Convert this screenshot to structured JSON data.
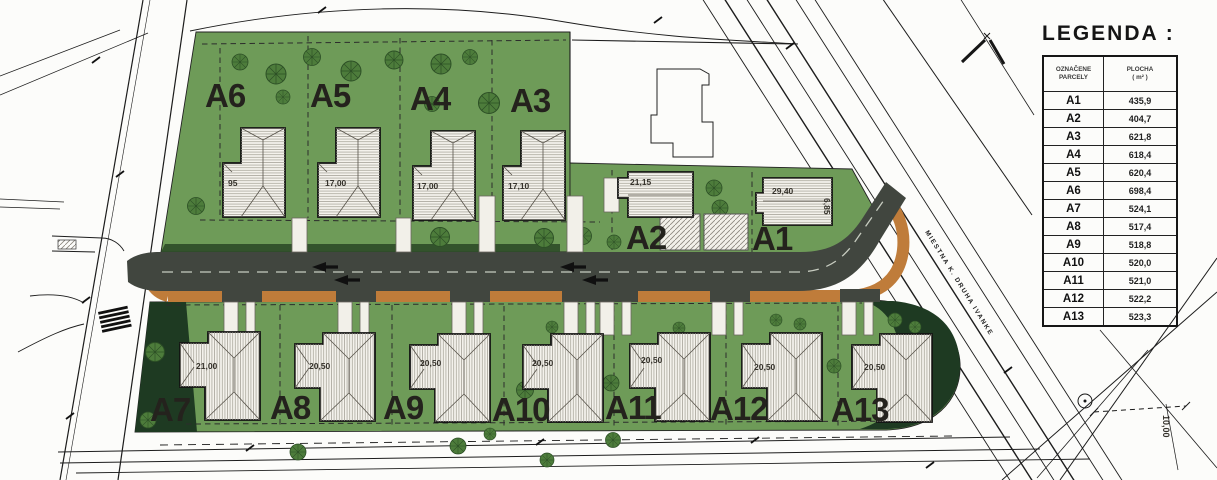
{
  "legend": {
    "title": "LEGENDA :",
    "header": {
      "parcel_line1": "OZNAČENE",
      "parcel_line2": "PARCELY",
      "area_line1": "PLOCHA",
      "area_line2": "( m² )"
    },
    "rows": [
      {
        "id": "A1",
        "area": "435,9"
      },
      {
        "id": "A2",
        "area": "404,7"
      },
      {
        "id": "A3",
        "area": "621,8"
      },
      {
        "id": "A4",
        "area": "618,4"
      },
      {
        "id": "A5",
        "area": "620,4"
      },
      {
        "id": "A6",
        "area": "698,4"
      },
      {
        "id": "A7",
        "area": "524,1"
      },
      {
        "id": "A8",
        "area": "517,4"
      },
      {
        "id": "A9",
        "area": "518,8"
      },
      {
        "id": "A10",
        "area": "520,0"
      },
      {
        "id": "A11",
        "area": "521,0"
      },
      {
        "id": "A12",
        "area": "522,2"
      },
      {
        "id": "A13",
        "area": "523,3"
      }
    ]
  },
  "plan": {
    "parcels_top": [
      {
        "label": "A6",
        "dim": "95"
      },
      {
        "label": "A5",
        "dim": "17,00"
      },
      {
        "label": "A4",
        "dim": "17,00"
      },
      {
        "label": "A3",
        "dim": "17,10"
      },
      {
        "label": "A2",
        "dim": "21,15"
      },
      {
        "label": "A1",
        "dim": "29,40",
        "side_dim": "6,85"
      }
    ],
    "parcels_bottom": [
      {
        "label": "A7",
        "dim": "21,00"
      },
      {
        "label": "A8",
        "dim": "20,50"
      },
      {
        "label": "A9",
        "dim": "20,50"
      },
      {
        "label": "A10",
        "dim": "20,50"
      },
      {
        "label": "A11",
        "dim": "20,50"
      },
      {
        "label": "A12",
        "dim": "20,50"
      },
      {
        "label": "A13",
        "dim": "20,50"
      }
    ],
    "road_label": "MIESTNA K. DRUHA IVANKE",
    "right_dim": "10,00"
  },
  "colors": {
    "site_green": "#6e9b58",
    "dark_green": "#1e3a22",
    "hedge_green": "#2c4b28",
    "road_gray": "#41463f",
    "sidewalk_orange": "#bf7c3a",
    "house_fill": "#f4f2ec"
  }
}
